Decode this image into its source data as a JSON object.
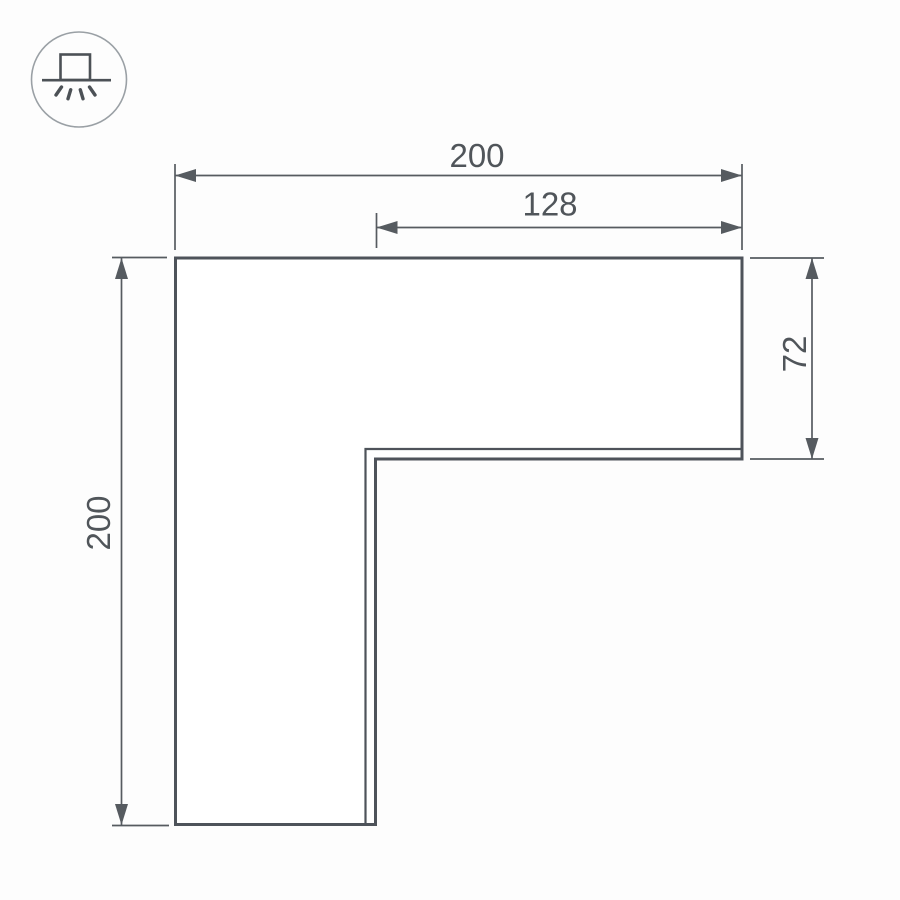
{
  "colors": {
    "background": "#fdfdfd",
    "shape_outline": "#4e535a",
    "dimension_line": "#565b60",
    "dimension_text": "#50555a",
    "icon_circle": "#9aa0a5",
    "icon_glyph": "#4c5156"
  },
  "icon": {
    "name": "surface-mounted-luminaire"
  },
  "dimensions": {
    "overall_width": "200",
    "inner_width": "128",
    "arm_height": "72",
    "overall_height": "200"
  }
}
